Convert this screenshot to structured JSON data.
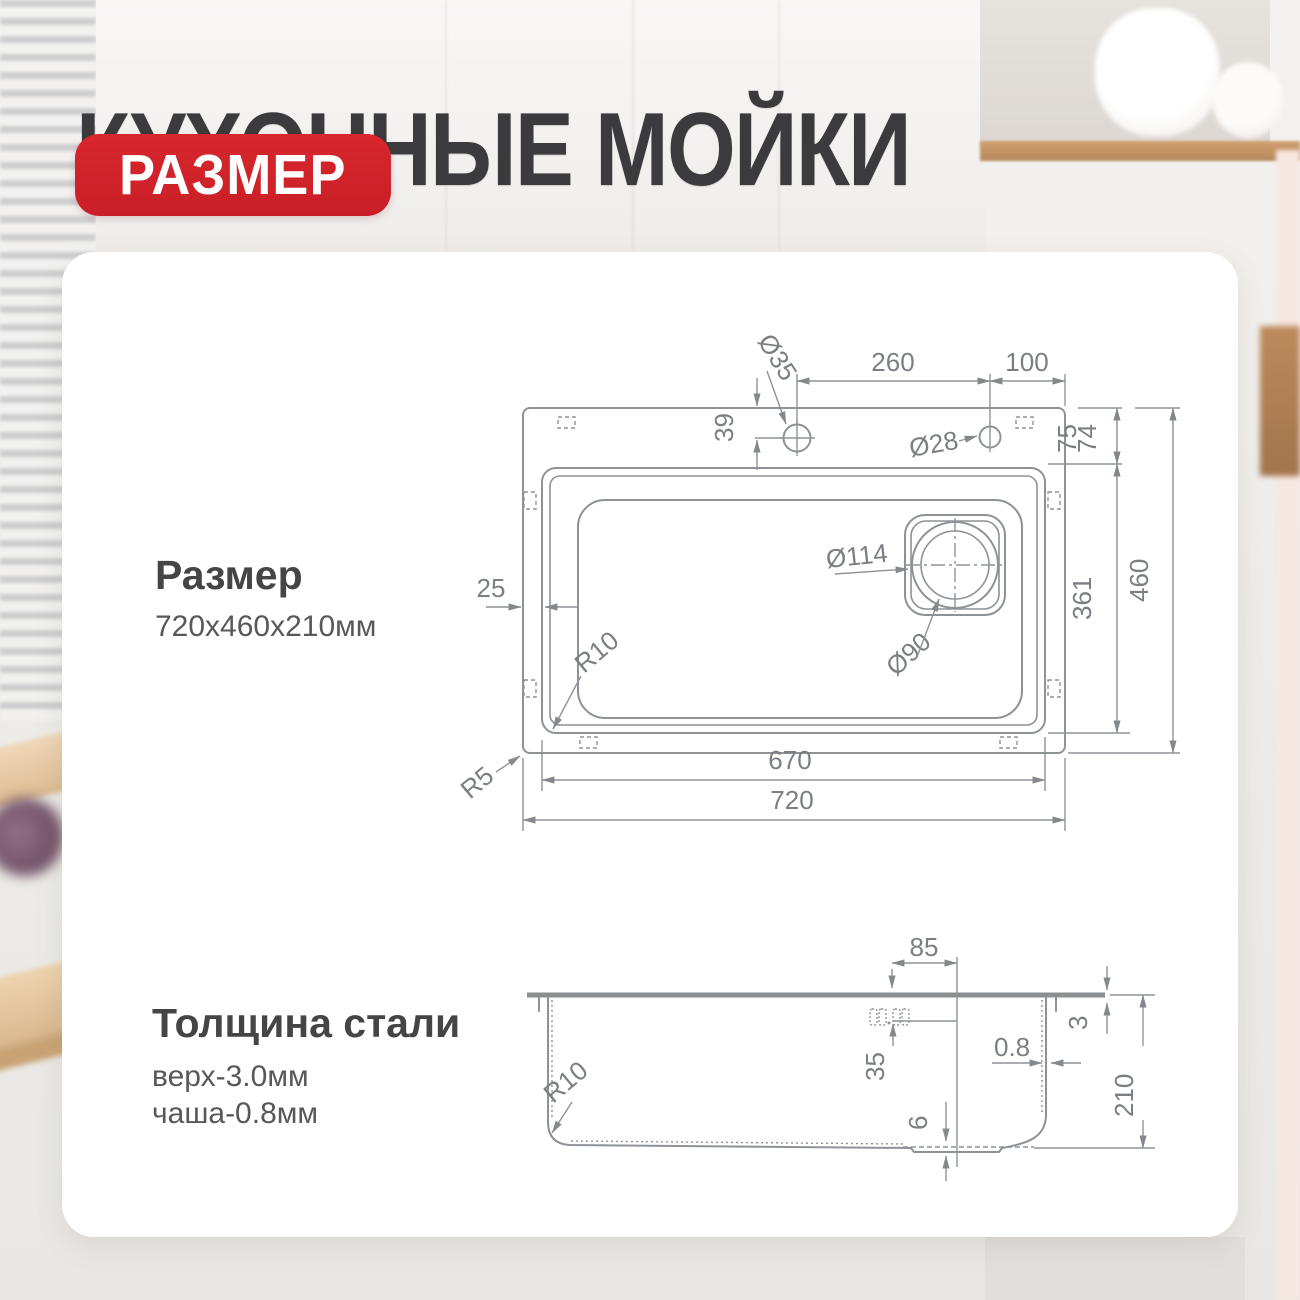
{
  "header": {
    "title": "КУХОННЫЕ МОЙКИ",
    "badge": "РАЗМЕР"
  },
  "size_section": {
    "heading": "Размер",
    "value": "720x460x210мм"
  },
  "steel_section": {
    "heading": "Толщина стали",
    "top_thickness": "верх-3.0мм",
    "bowl_thickness": "чаша-0.8мм"
  },
  "top_view": {
    "dims": {
      "hole_spacing": "260",
      "hole_to_edge": "100",
      "hole_offset_from_edge": "39",
      "faucet_hole_diameter": "Ø35",
      "accessory_hole_diameter": "Ø28",
      "deck_top_75": "75",
      "deck_top_74": "74",
      "bowl_inner_length": "361",
      "overall_depth": "460",
      "deck_side": "25",
      "bowl_corner_radius": "R10",
      "outer_corner_radius": "R5",
      "drain_flange_diameter": "Ø114",
      "drain_hole_diameter": "Ø90",
      "bowl_width": "670",
      "overall_width": "720"
    }
  },
  "side_view": {
    "dims": {
      "drain_offset": "85",
      "overflow_depth": "35",
      "recess_depth": "6",
      "bowl_wall_thickness": "0.8",
      "top_plate_thickness": "3",
      "overall_height": "210",
      "bottom_corner_radius": "R10"
    }
  },
  "colors": {
    "accent_red": "#d2232b",
    "title_text": "#3b3b3d",
    "drawing_line": "#8e9296",
    "dimension_text": "#7b7f83"
  }
}
